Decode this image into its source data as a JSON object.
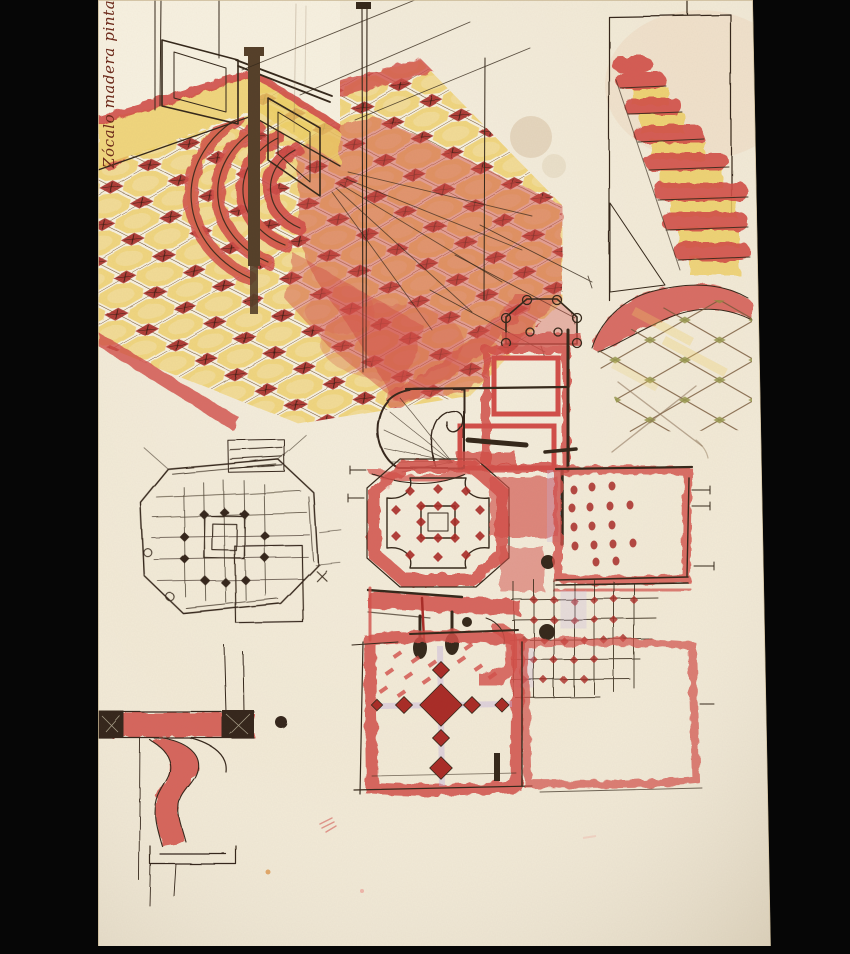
{
  "annotation": {
    "text": "Zócalo madera pintada"
  },
  "palette": {
    "frame": "#060606",
    "paper": "#f2ead7",
    "paperLight": "#f7f1e1",
    "paperEdge": "#c9b794",
    "ink": "#35281b",
    "inkSoft": "#8a7055",
    "maroon": "#6d2a1b",
    "red": "#d24f4a",
    "redDeep": "#a92c27",
    "pink": "#eda89f",
    "yellow": "#eecf66",
    "yellowPale": "#f4e4ab",
    "olive": "#8e8f3f",
    "lavender": "#c5b3dd",
    "stain": "#cfb48e",
    "wood": "#55402a",
    "gridBrown": "#77583a"
  }
}
